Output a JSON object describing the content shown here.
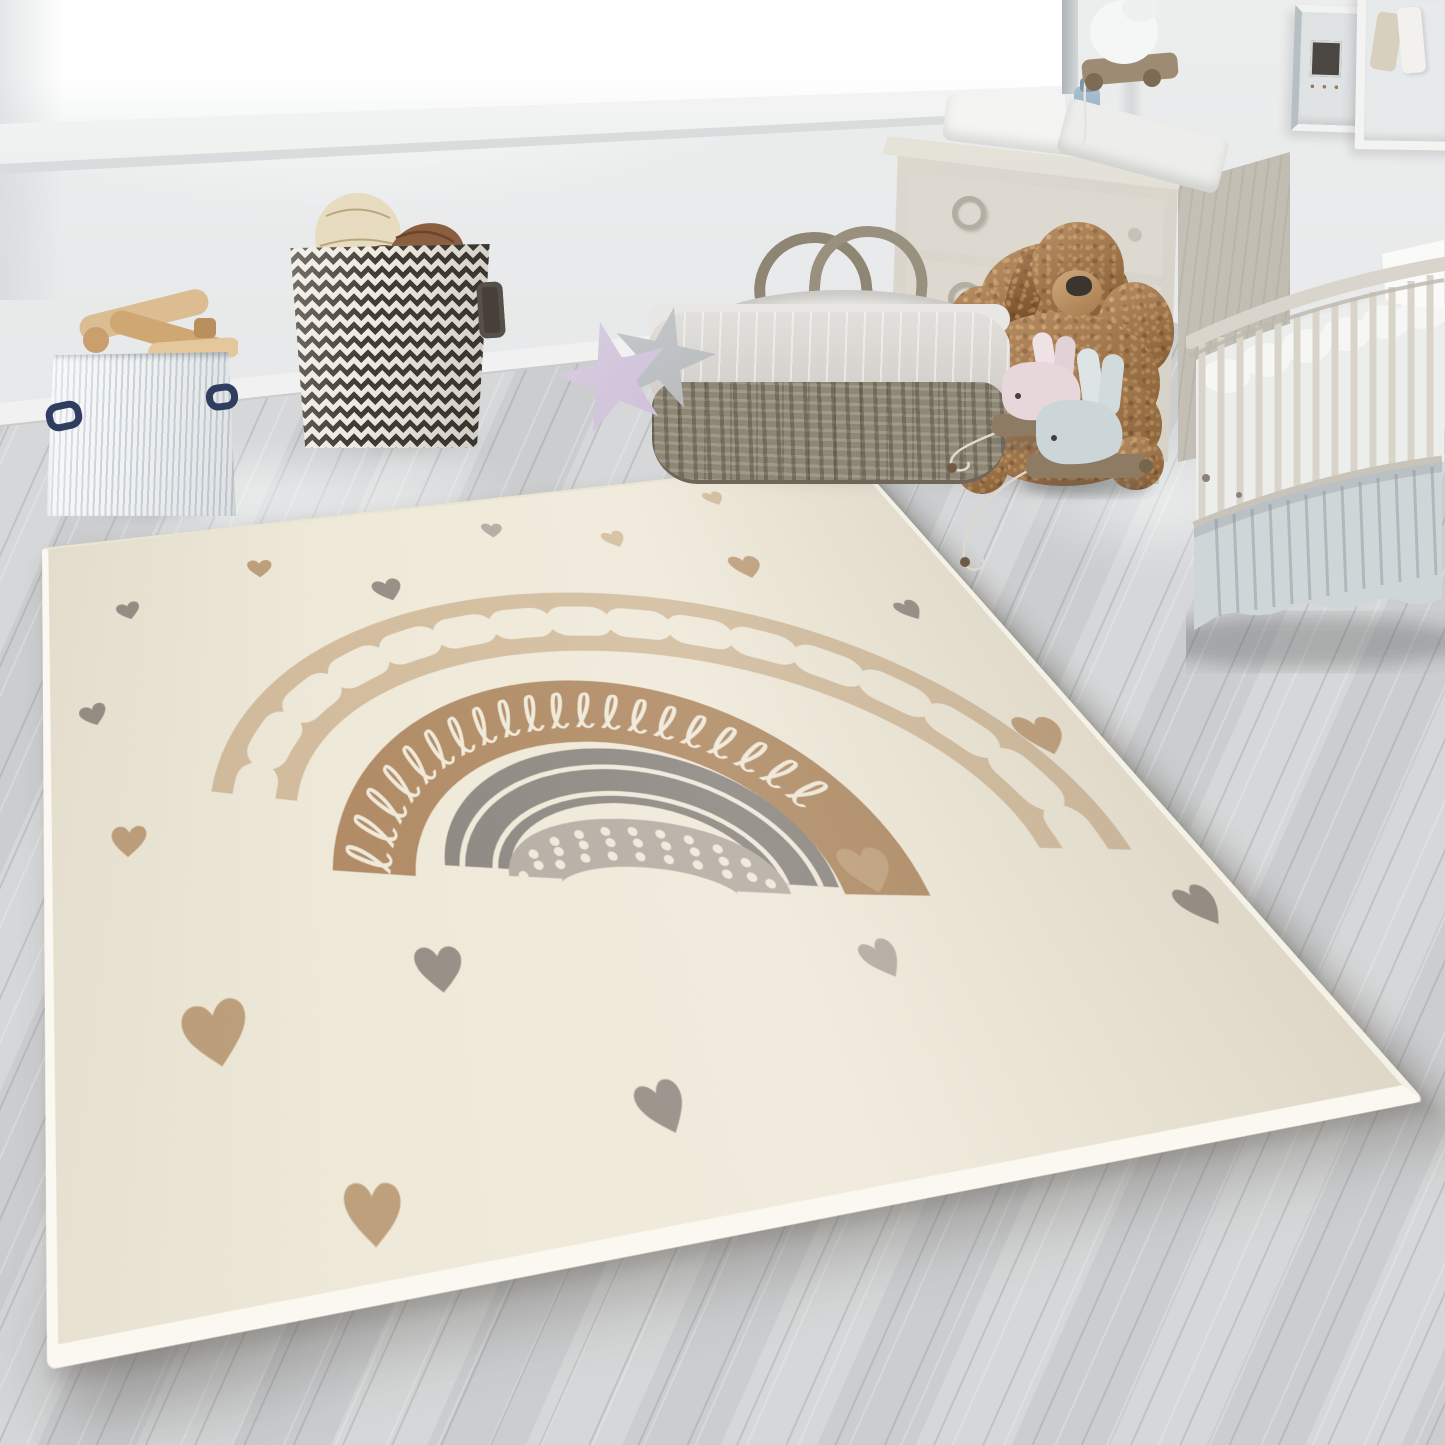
{
  "description": "Bright nursery-room product photo: a cream kids rug with a boho rainbow and scattered beige/grey hearts lies on grey wood flooring; around it a window, shadow-box frames, a whitewashed dresser with changing mat, a round white crib, a plush dog armchair, a wicker moses basket, star cushions, a chevron basket with balls, a striped toy box with wooden toys and whale pull-along toys.",
  "image_text": [],
  "palette": {
    "wall": "#e6e8e9",
    "floor": "#d0d2d3",
    "rugCream": "#efe9d9",
    "rugFringe": "#faf8f0",
    "rainbowBeige": "#d3bd9e",
    "rainbowTan": "#b18c66",
    "rainbowGrey": "#8e8882",
    "rainbowLight": "#b5aea4",
    "heartBeige": "#bfa07c",
    "heartBeigeLight": "#d3bd9c",
    "heartGrey": "#978f86",
    "heartGreyLight": "#b2aba1",
    "woodLight": "#dad6cd",
    "wicker": "#8f8775",
    "plushBrown": "#a06f41",
    "skirtBlue": "#cfd6d8",
    "navy": "#2f3d60",
    "lavender": "#cdbfd8",
    "starGrey": "#b7babd",
    "chevron": "#413c37",
    "sledWood": "#8d7b63",
    "whalePink": "#e7d7db",
    "whaleBlue": "#ccd5d7"
  },
  "labels": {
    "scene": "Nursery room with rainbow hearts rug",
    "window": "Bright window",
    "sill": "White window sill",
    "frames": "Shadow-box picture frames",
    "dresser": "Whitewashed dresser with changing mat",
    "crib": "Round white crib with ruffled skirt",
    "dogChair": "Brown plush dog armchair",
    "mosesBasket": "Wicker moses basket with grey liner",
    "stars": "Star cushions",
    "chevronBox": "Chevron storage basket with balls",
    "stripedBox": "Striped toy box with wooden toys",
    "pullToys": "Whale pull-along toys",
    "sillToy": "White pull toy on window sill",
    "rug": "Cream kids rug with rainbow and hearts",
    "floor": "Grey wood floor"
  },
  "rug_design": {
    "background": "cream",
    "bands_outer_to_inner": [
      "beige band with cream bean-shaped dots",
      "tan band with cream loop doodle line",
      "grey band with two cream pinstripes",
      "light grey band with cream polka dots"
    ],
    "heart_colors": [
      "beige",
      "light beige",
      "grey",
      "light grey"
    ],
    "heart_count": 18
  }
}
